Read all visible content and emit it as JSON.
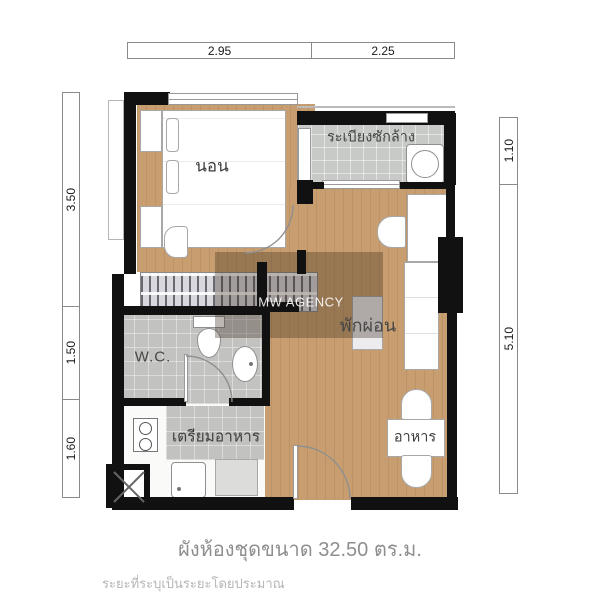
{
  "dims": {
    "top": [
      "2.95",
      "2.25"
    ],
    "left": [
      "3.50",
      "1.50",
      "1.60"
    ],
    "right": [
      "1.10",
      "5.10"
    ]
  },
  "rooms": {
    "bedroom": {
      "label": "นอน"
    },
    "laundry_balcony": {
      "label": "ระเบียงซักล้าง"
    },
    "living": {
      "label": "พักผ่อน"
    },
    "wc": {
      "label": "W.C."
    },
    "kitchen": {
      "label": "เตรียมอาหาร"
    },
    "dining": {
      "label": "อาหาร"
    }
  },
  "watermark": {
    "text": "MW AGENCY"
  },
  "footer": {
    "title": "ผังห้องชุดขนาด 32.50 ตร.ม.",
    "note": "ระยะที่ระบุเป็นระยะโดยประมาณ"
  },
  "colors": {
    "wall": "#111111",
    "wood_floor": "#c89e70",
    "tile_floor": "#c7cac6",
    "watermark_overlay": "rgba(60,44,30,0.34)",
    "title_text": "#8e8e8e",
    "note_text": "#b6b6b6"
  }
}
